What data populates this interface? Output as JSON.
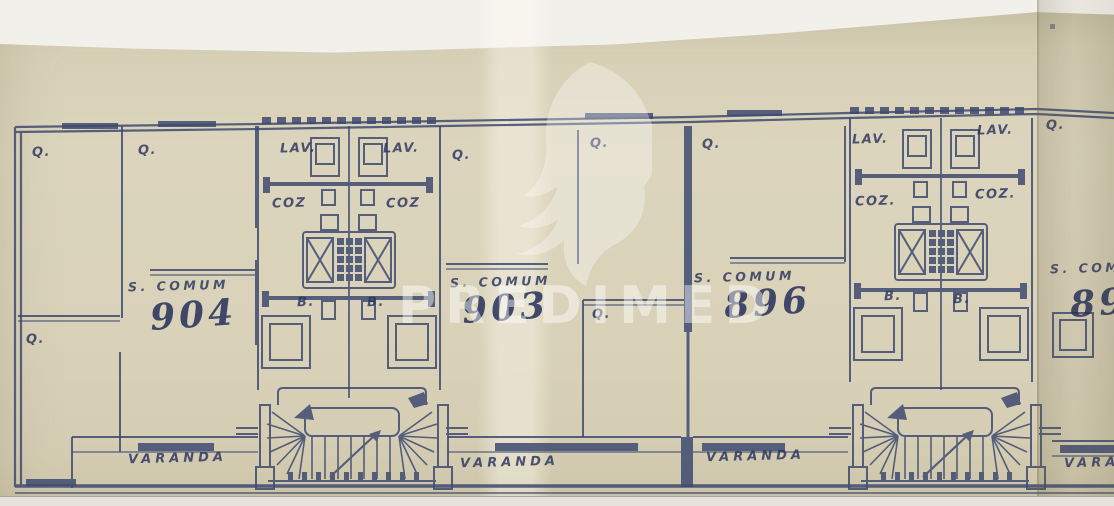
{
  "watermark": {
    "icon": "dove-icon",
    "text": "PREDIMED"
  },
  "room_labels": {
    "bedroom": "Q.",
    "living_room": "S. COMUM",
    "laundry": "LAV.",
    "kitchen": "COZ",
    "kitchen_dotted": "COZ.",
    "bathroom": "B.",
    "balcony": "VARANDA"
  },
  "units": [
    {
      "number": "904"
    },
    {
      "number": "903"
    },
    {
      "number": "896"
    },
    {
      "number": "895"
    }
  ],
  "colors": {
    "ink": "#3e4a70",
    "paper": "#d9d2b9",
    "background": "#f2f0eb",
    "watermark": "rgba(255,255,255,0.45)"
  }
}
